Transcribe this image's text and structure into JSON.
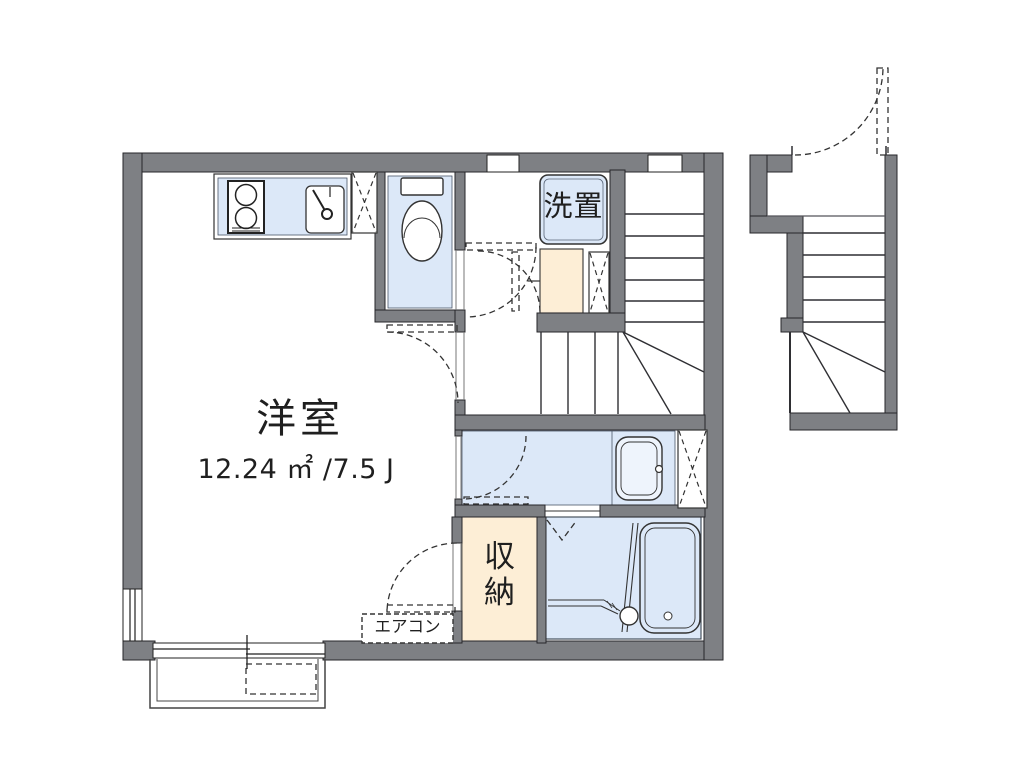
{
  "floorplan": {
    "rooms": {
      "main_room": {
        "label": "洋室",
        "area": "12.24 ㎡ /7.5 J"
      },
      "laundry": {
        "label": "洗置"
      },
      "storage": {
        "label": "収納"
      },
      "aircon": {
        "label": "エアコン"
      }
    },
    "colors": {
      "wall": "#7e8084",
      "room_fill": "#dce8f8",
      "storage_fill": "#fdeed6",
      "line": "#2b2b2e",
      "background": "#ffffff"
    },
    "fixtures": {
      "stove": "gas-stove-icon",
      "kitchen_sink": "kitchen-sink-icon",
      "toilet": "toilet-icon",
      "vanity": "vanity-sink-icon",
      "bathtub": "bathtub-icon",
      "water_heater": "water-heater-box",
      "pipe_space": "pipe-space-x-icon",
      "stairs_inner": "staircase-icon",
      "stairs_entrance": "entrance-staircase-icon",
      "balcony": "balcony",
      "outdoor_unit": "ac-outdoor-unit",
      "sliding_window": "sliding-window-icon"
    }
  }
}
